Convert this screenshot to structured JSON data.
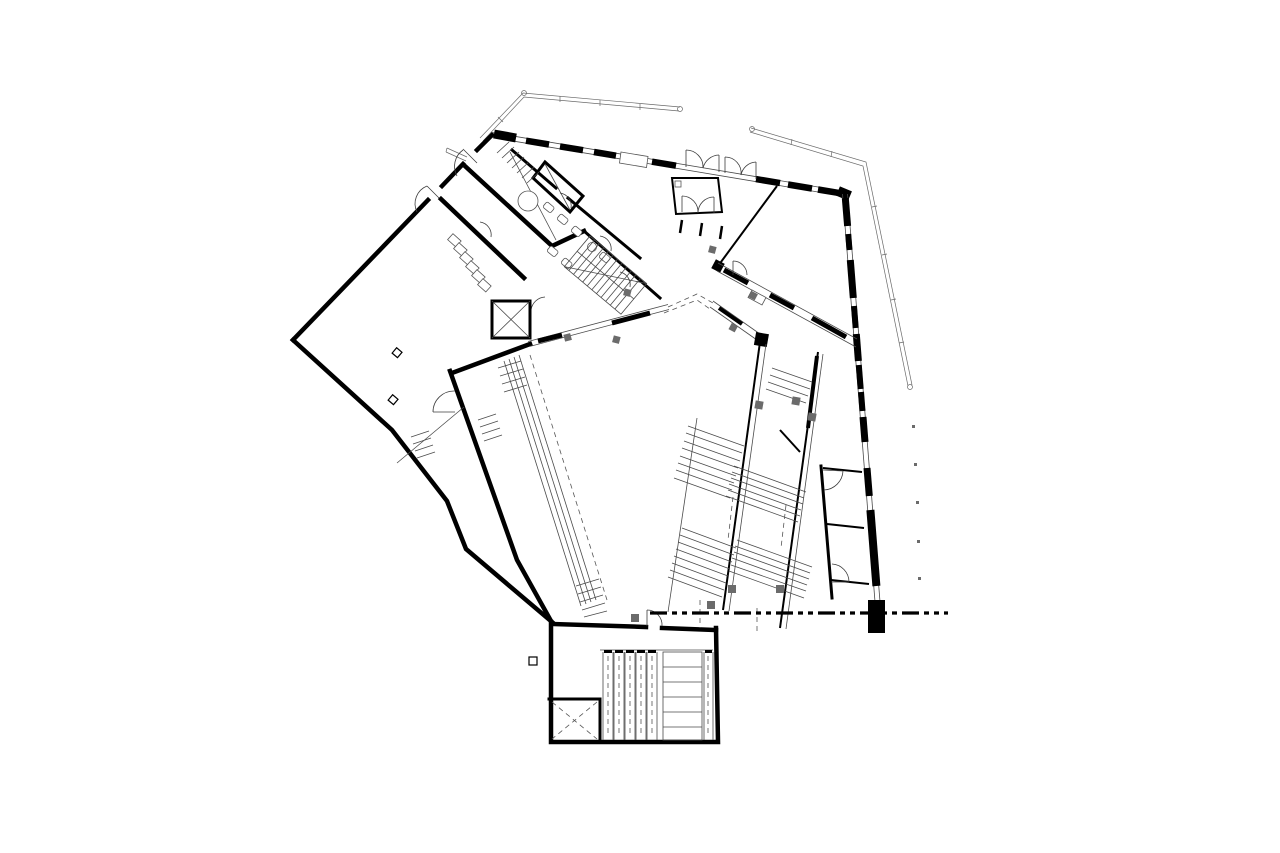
{
  "document": {
    "type": "architectural-floor-plan",
    "visible_text": "",
    "description_of_depiction": "ground-floor plan, black line drawing on white"
  },
  "colors": {
    "paper": "#ffffff",
    "ink": "#000000",
    "column_gray": "#6b6b6b",
    "light_line": "#4a4a4a"
  },
  "plan_elements": {
    "canopy_left": "thin double roof edge line, top left",
    "canopy_right": "thin double roof edge line, top right",
    "curtain_wall_top": "glazed wall with black pier segments",
    "curtain_wall_east": "glazed wall with black pier segments",
    "entrance_vestibule": "double-door lobby on north wall",
    "toilet_block": "WC stalls, lockers, dog-leg stair, shafts",
    "elevator_upper": "shaft with X",
    "elevator_lower": "shaft with dashed X",
    "main_hall": "large open space with ramp along west wall",
    "grand_stairs": "two pairs of diagonal stair runs with flank walls",
    "east_rooms": "three small rooms along east curtain wall",
    "escalator_block": "five escalator strips plus stair, bottom",
    "section_line": "dash-dot-dot cutting line, lower right",
    "columns": "small gray and outlined square columns",
    "support_dots": "row of small canopy support dots, right side"
  }
}
